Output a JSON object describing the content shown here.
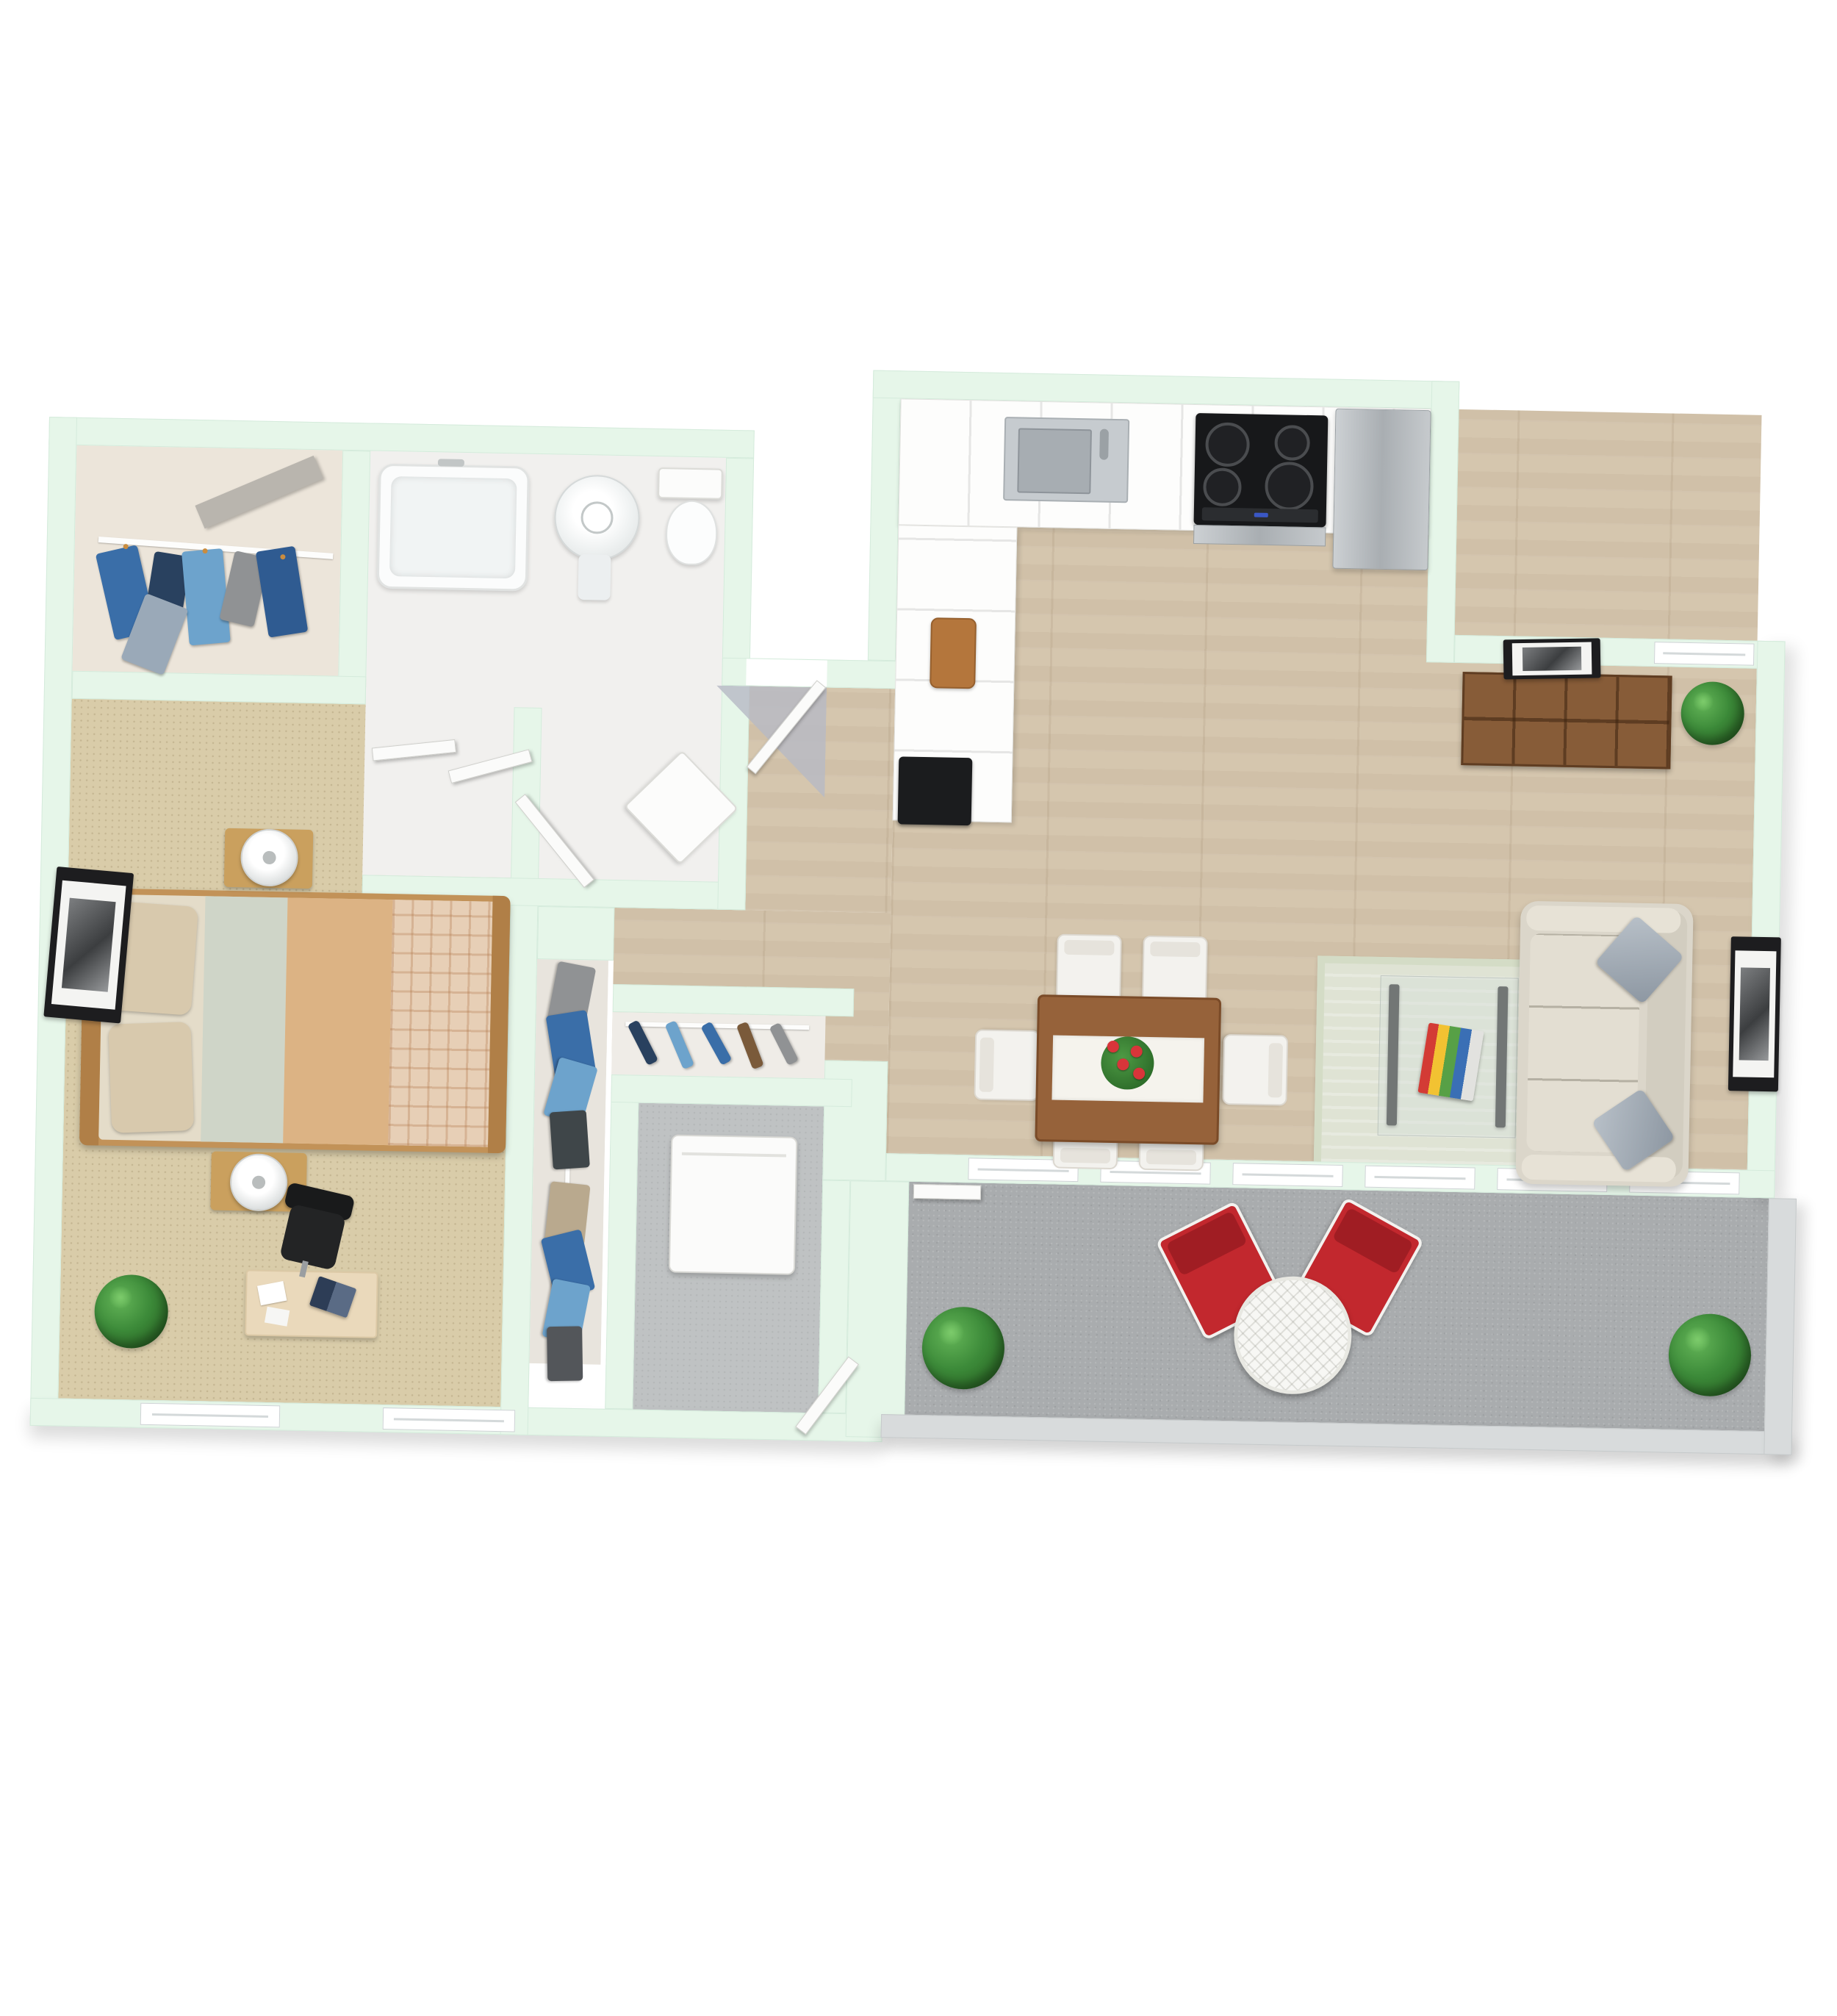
{
  "document_type": "3d-apartment-floor-plan-rendering",
  "visible_text": [],
  "palette": {
    "wall_mint": "#e6f6e9",
    "wall_edge": "#d5ebdc",
    "wood_floor": "#d5c6ae",
    "carpet": "#d9cca9",
    "balcony_floor": "#a9acae",
    "parapet": "#d8dbdc",
    "storage_floor": "#bfc2c3",
    "closet_floor": "#ece5da",
    "bath_floor": "#f1f0ee",
    "rug": "#dfe3d4",
    "sofa": "#dbd6ca",
    "dining_table": "#96623a",
    "bookshelf": "#875c38",
    "red_chair": "#c2282e",
    "stove": "#17181a",
    "stainless": "#b9bec2",
    "bed_frame": "#c29258",
    "blanket": "#dcb384",
    "sheet": "#cfd5c8",
    "bed_pillow": "#d8c9ad",
    "blue_dark": "#29415f",
    "blue_mid": "#3a6ea8",
    "blue_light": "#6da3cc",
    "cloth_gray": "#909294",
    "white_fixture": "#fcfcfb"
  },
  "rooms": {
    "bedroom": {
      "label": "bedroom",
      "floor": "carpet"
    },
    "walk_in_closet": {
      "label": "walk-in closet",
      "floor": "plain"
    },
    "bathroom": {
      "label": "bathroom",
      "floor": "tile"
    },
    "wardrobe": {
      "label": "reach-in wardrobe",
      "floor": "plain"
    },
    "hallway": {
      "label": "entry hallway",
      "floor": "wood"
    },
    "coat_closet": {
      "label": "coat closet",
      "floor": "plain"
    },
    "storage": {
      "label": "storage / laundry room",
      "floor": "concrete"
    },
    "kitchen": {
      "label": "kitchen",
      "floor": "wood"
    },
    "dining": {
      "label": "dining area",
      "floor": "wood"
    },
    "living": {
      "label": "living room",
      "floor": "wood"
    },
    "balcony": {
      "label": "balcony",
      "floor": "concrete"
    }
  },
  "furniture": {
    "bedroom": [
      "double-bed",
      "nightstand x2",
      "table-lamp x2",
      "desk",
      "laptop",
      "office-chair",
      "potted-plant",
      "wall-art",
      "window x2",
      "sliding-door x2"
    ],
    "bathroom": [
      "bathtub",
      "pedestal-sink",
      "toilet",
      "corner-cabinet",
      "door"
    ],
    "walk_in_closet": [
      "clothes-rail",
      "hanging-clothes x6",
      "shelf-board"
    ],
    "wardrobe": [
      "clothes-rail",
      "hanging-clothes x8"
    ],
    "coat_closet": [
      "clothes-rail",
      "hanging-clothes x5"
    ],
    "storage": [
      "washing-machine",
      "door"
    ],
    "kitchen": [
      "upper-counter-run",
      "side-counter-run",
      "stainless-sink",
      "faucet",
      "cooktop-4-burner",
      "refrigerator",
      "cutting-board",
      "black-appliance"
    ],
    "dining": [
      "dining-table",
      "table-runner",
      "flower-vase",
      "dining-chair x6"
    ],
    "living": [
      "sofa-3-seat",
      "throw-pillow x2",
      "area-rug",
      "glass-coffee-table",
      "book-stack",
      "shelving-unit",
      "potted-plant",
      "wall-art x2",
      "window"
    ],
    "balcony": [
      "red-armchair x2",
      "round-wicker-table",
      "bush-plant x2",
      "balcony-door",
      "window-row x6"
    ],
    "entry": [
      "entry-door",
      "door-swing"
    ]
  },
  "counts": {
    "dining_chairs": 6,
    "balcony_windows": 6,
    "bedroom_windows": 2,
    "red_chairs": 2,
    "plants": 4
  }
}
